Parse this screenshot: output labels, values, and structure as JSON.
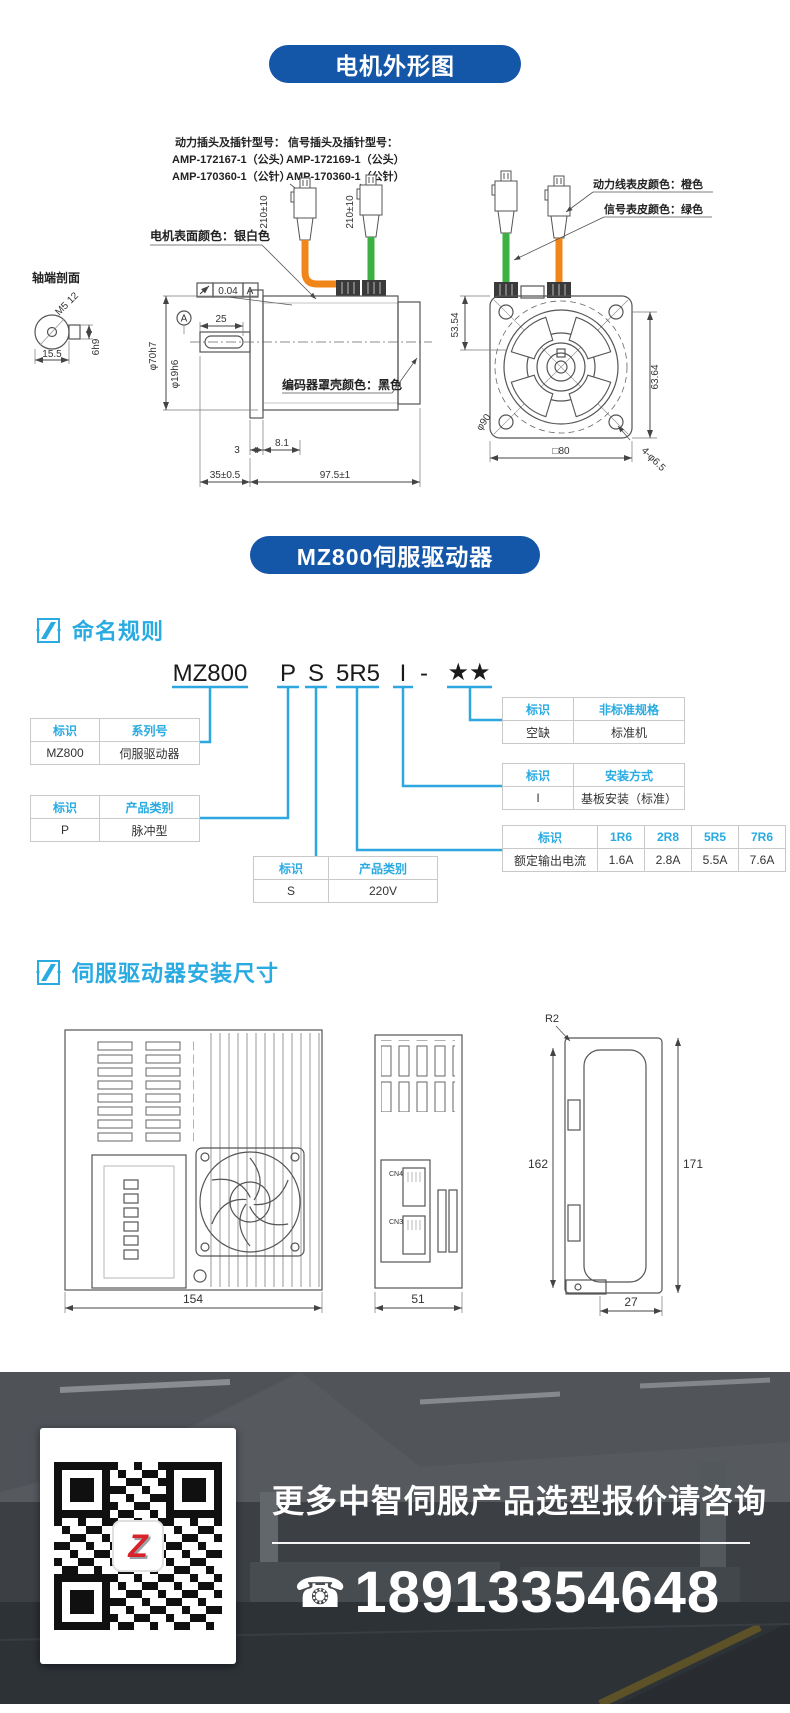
{
  "banners": {
    "motor": "电机外形图",
    "driver": "MZ800伺服驱动器"
  },
  "motor": {
    "plug_info": {
      "power_title": "动力插头及插针型号：",
      "power_head": "AMP-172167-1（公头）",
      "power_pin": "AMP-170360-1（公针）",
      "signal_title": "信号插头及插针型号：",
      "signal_head": "AMP-172169-1（公头）",
      "signal_pin": "AMP-170360-1（公针）"
    },
    "labels": {
      "surface": "电机表面颜色：银白色",
      "shaft_section": "轴端剖面",
      "encoder": "编码器罩壳颜色：黑色",
      "power_cable": "动力线表皮颜色：橙色",
      "signal_cable": "信号表皮颜色：绿色"
    },
    "dims": {
      "cable_len": "210±10",
      "runout": "0.04",
      "datum": "A",
      "shaft_ext": "25",
      "body_dia": "φ70h7",
      "shaft_dia": "φ19h6",
      "key_offset": "15.5",
      "key": "6h9",
      "tap": "M5 12",
      "front1": "3",
      "front2": "8.1",
      "shaft_len": "35±0.5",
      "body_len": "97.5±1",
      "flange_v1": "53.54",
      "flange_v2": "63.64",
      "pilot": "φ90",
      "holes": "4-φ6.5",
      "square": "□80"
    }
  },
  "naming": {
    "title": "命名规则",
    "code": [
      "MZ800",
      "P",
      "S",
      "5R5",
      "I",
      "-",
      "★★"
    ],
    "t1": {
      "h": [
        "标识",
        "系列号"
      ],
      "r": [
        "MZ800",
        "伺服驱动器"
      ]
    },
    "t2": {
      "h": [
        "标识",
        "产品类别"
      ],
      "r": [
        "P",
        "脉冲型"
      ]
    },
    "t3": {
      "h": [
        "标识",
        "产品类别"
      ],
      "r": [
        "S",
        "220V"
      ]
    },
    "t4": {
      "h": [
        "标识",
        "非标准规格"
      ],
      "r": [
        "空缺",
        "标准机"
      ]
    },
    "t5": {
      "h": [
        "标识",
        "安装方式"
      ],
      "r": [
        "I",
        "基板安装（标准）"
      ]
    },
    "t6": {
      "h": [
        "标识",
        "1R6",
        "2R8",
        "5R5",
        "7R6"
      ],
      "r": [
        "额定输出电流",
        "1.6A",
        "2.8A",
        "5.5A",
        "7.6A"
      ]
    }
  },
  "install": {
    "title": "伺服驱动器安装尺寸",
    "dims": {
      "w": "154",
      "d": "51",
      "t": "27",
      "h1": "162",
      "h2": "171",
      "r": "R2"
    },
    "ports": {
      "cn4": "CN4",
      "cn3": "CN3"
    }
  },
  "footer": {
    "headline": "更多中智伺服产品选型报价请咨询",
    "phone": "18913354648",
    "qr_logo": "Z"
  },
  "colors": {
    "banner_blue": "#1456A8",
    "accent_blue": "#29ABE2",
    "cable_orange": "#F08519",
    "cable_green": "#3CB043",
    "logo_red": "#D8232A"
  }
}
